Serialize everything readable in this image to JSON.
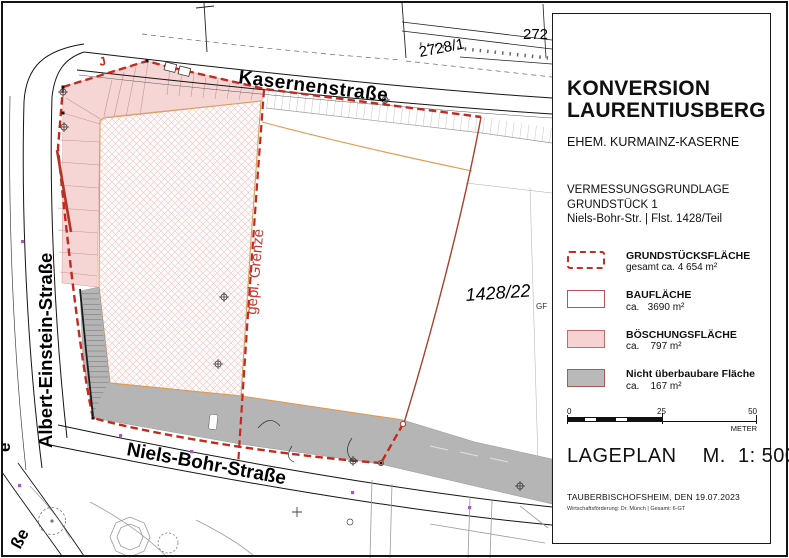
{
  "panel": {
    "title_line1": "KONVERSION",
    "title_line2": "LAURENTIUSBERG",
    "subtitle": "EHEM. KURMAINZ-KASERNE",
    "block": {
      "line1": "VERMESSUNGSGRUNDLAGE",
      "line2": "GRUNDSTÜCK 1",
      "line3": "Niels-Bohr-Str. | Flst. 1428/Teil"
    },
    "legend": [
      {
        "name": "GRUNDSTÜCKSFLÄCHE",
        "value": "gesamt ca. 4 654 m²",
        "swatch": "dashed-red-outline"
      },
      {
        "name": "BAUFLÄCHE",
        "value": "ca.   3690 m²",
        "swatch": "white-red-border"
      },
      {
        "name": "BÖSCHUNGSFLÄCHE",
        "value": "ca.    797 m²",
        "swatch": "pink-red-border"
      },
      {
        "name": "Nicht überbaubare Fläche",
        "value": "ca.    167 m²",
        "swatch": "gray-red-border"
      }
    ],
    "scalebar": {
      "tick0": "0",
      "tick25": "25",
      "tick50": "50",
      "unit": "METER"
    },
    "plan_type": "LAGEPLAN",
    "scale_text": "M.  1: 500",
    "place_date": "TAUBERBISCHOFSHEIM, DEN  19.07.2023",
    "credit": "Wirtschaftsförderung: Dr. Münch  |  Gesamt: 6-GT"
  },
  "map": {
    "labels": {
      "street_top": "Kasernenstraße",
      "street_left": "Albert-Einstein-Straße",
      "street_bottom": "Niels-Bohr-Straße",
      "street_fragment_e": "e",
      "street_fragment_sse": "ße",
      "parcel_2728_1": "2728/1",
      "parcel_272": "272",
      "parcel_1428_22": "1428/22",
      "parcel_1428_22_suffix": "GF",
      "planned_boundary": "gepl. Grenze",
      "red_mark": "J"
    },
    "colors": {
      "boundary_red": "#c5291d",
      "boundary_solid": "#a8402e",
      "slope_pink": "#f6d5d5",
      "asphalt_gray": "#b5b5b5",
      "bau_edge_orange": "#e29a4e",
      "marker_purple": "#a757c9"
    }
  }
}
